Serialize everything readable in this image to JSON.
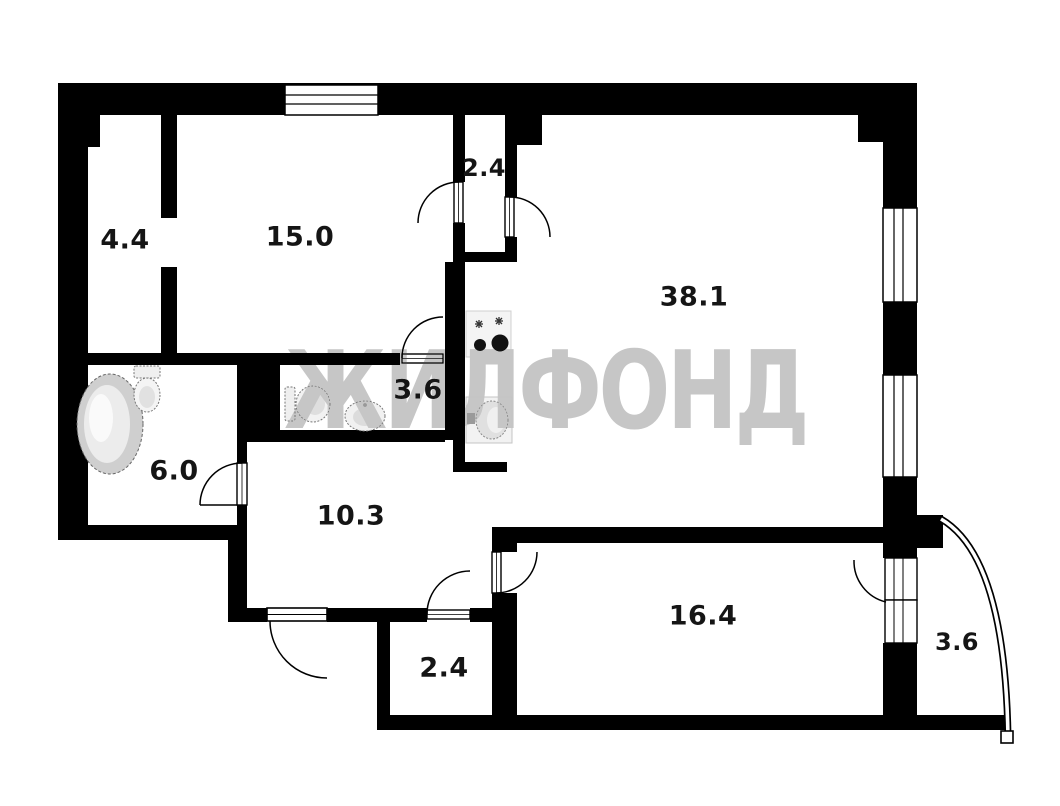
{
  "watermark": {
    "text": "ЖИЛФОНД",
    "color": "#c6c6c6"
  },
  "plan": {
    "wall_color": "#000000",
    "floor_color": "#ffffff"
  },
  "rooms": {
    "hall": {
      "area": "4.4"
    },
    "bedroom": {
      "area": "15.0"
    },
    "wardrobe_top": {
      "area": "2.4"
    },
    "kitchen_living": {
      "area": "38.1"
    },
    "wc": {
      "area": "3.6"
    },
    "bathroom": {
      "area": "6.0"
    },
    "hallway": {
      "area": "10.3"
    },
    "wardrobe_bottom": {
      "area": "2.4"
    },
    "bedroom2": {
      "area": "16.4"
    },
    "balcony": {
      "area": "3.6"
    }
  },
  "fixtures": [
    "bathtub-icon",
    "toilet-icon",
    "toilet-icon",
    "wash-sink-icon",
    "stove-icon",
    "kitchen-sink-icon"
  ],
  "openings": [
    "entrance-door",
    "bathroom-door",
    "wc-door",
    "wardrobe-top-left-door",
    "wardrobe-top-right-door",
    "wardrobe-bottom-door",
    "room2-door",
    "balcony-door",
    "window",
    "window",
    "window",
    "balcony-railing"
  ]
}
